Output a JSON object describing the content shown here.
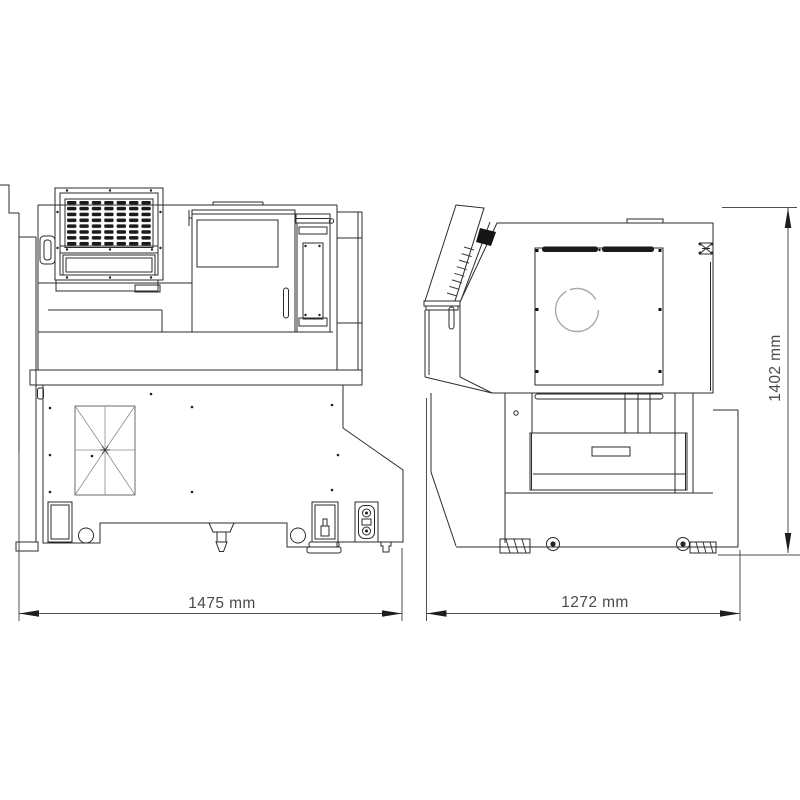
{
  "page": {
    "background": "#ffffff"
  },
  "drawing": {
    "title": "CNC lathe machine - 2 view dimensional outline drawing",
    "type": "technical-line-drawing",
    "line_color": "#2b2b2b",
    "dimension_text_color": "#4a4a4a",
    "views": [
      {
        "name": "front elevation",
        "position": "left",
        "overall_width": "1475 mm"
      },
      {
        "name": "side elevation",
        "position": "right",
        "overall_width": "1272 mm",
        "overall_height": "1402 mm"
      }
    ],
    "dimensions": {
      "front_width": "1475 mm",
      "side_width": "1272 mm",
      "height": "1402 mm"
    }
  }
}
